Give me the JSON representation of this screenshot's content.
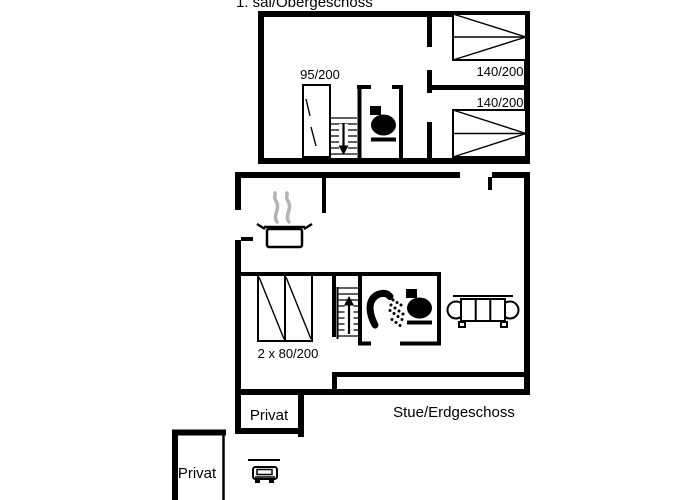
{
  "titles": {
    "upper": "1. sal/Obergeschoss",
    "ground": "Stue/Erdgeschoss"
  },
  "labels": {
    "wardrobe": "95/200",
    "bed_top": "140/200",
    "bed_bottom": "140/200",
    "bunk": "2 x 80/200",
    "privat_room": "Privat",
    "privat_carport": "Privat"
  },
  "colors": {
    "wall": "#000000",
    "background": "#ffffff",
    "steam": "#b3b3b3"
  },
  "icons": [
    "toilet-icon-upper",
    "toilet-icon-ground",
    "shower-icon",
    "cooking-pot-icon",
    "sofa-icon",
    "car-icon",
    "stairs-down-icon",
    "stairs-up-icon",
    "wardrobe-icon",
    "double-bed-icon",
    "bunk-bed-icon"
  ]
}
